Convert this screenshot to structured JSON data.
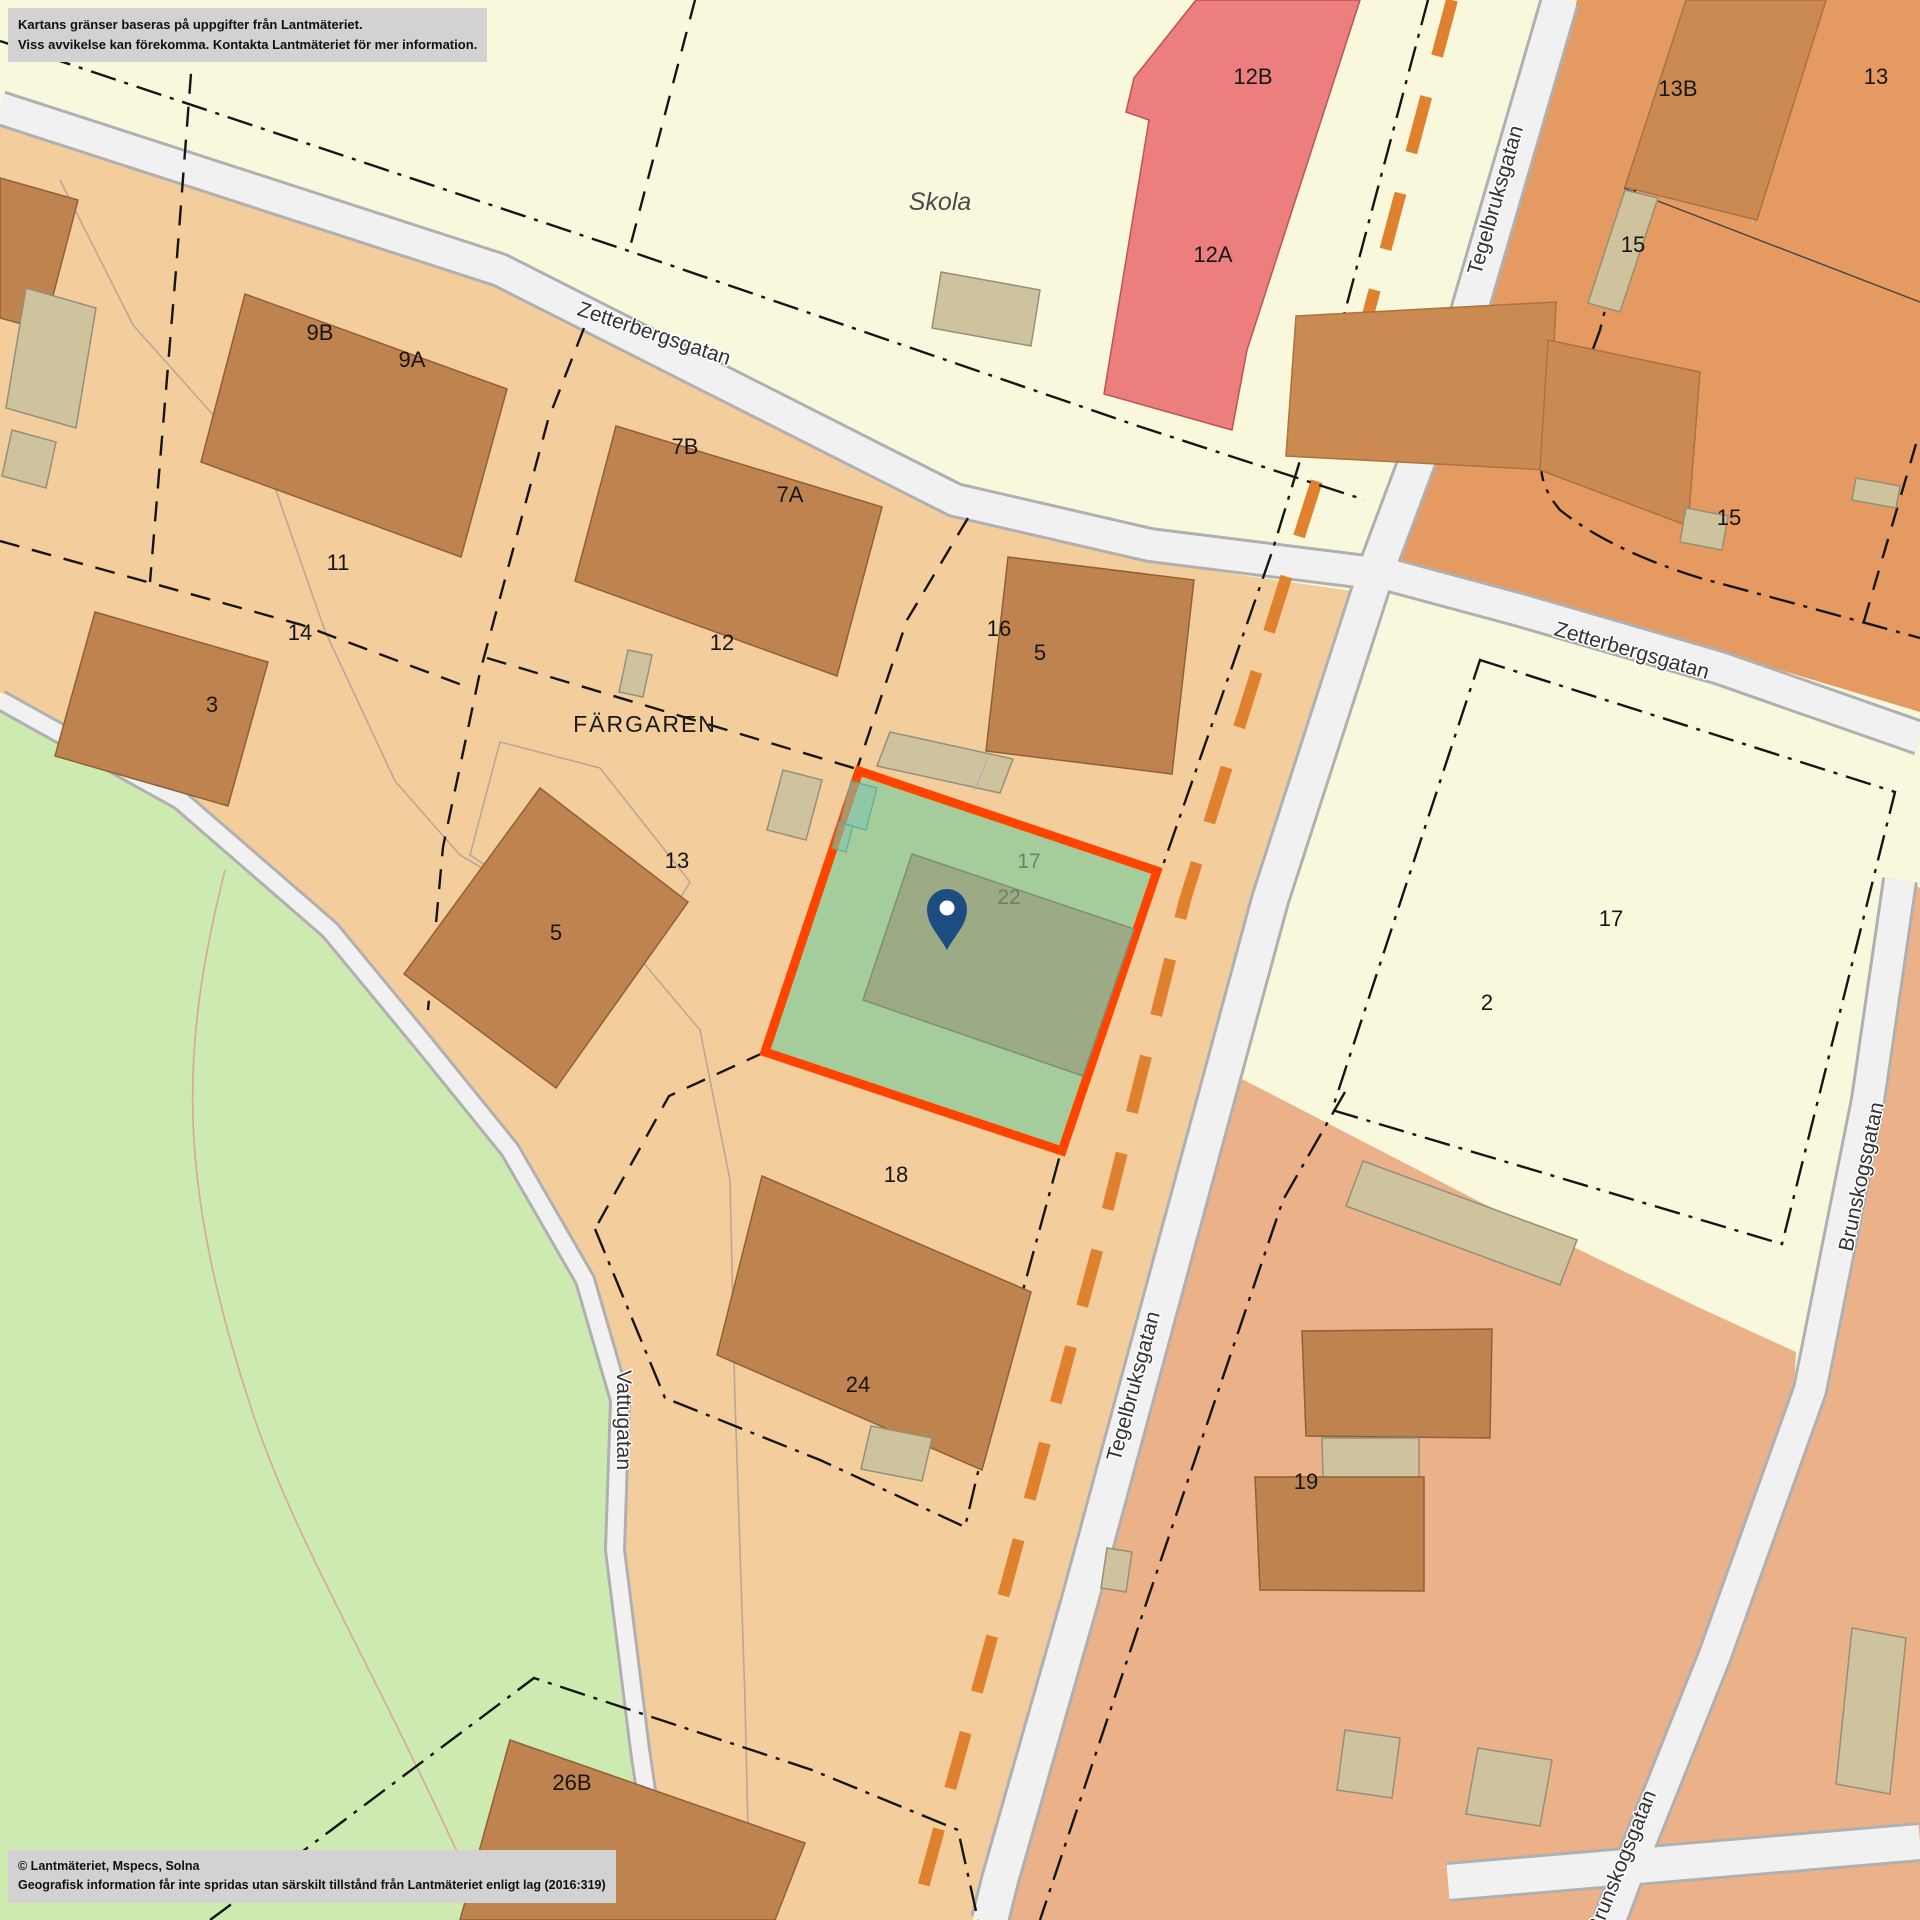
{
  "disclaimer": {
    "line1": "Kartans gränser baseras på uppgifter från Lantmäteriet.",
    "line2": "Viss avvikelse kan förekomma. Kontakta Lantmäteriet för mer information."
  },
  "attribution": {
    "line1": "© Lantmäteriet, Mspecs, Solna",
    "line2": "Geografisk information får inte spridas utan särskilt tillstånd från Lantmäteriet enligt lag (2016:319)"
  },
  "streets": {
    "zetterbergsgatan_left": "Zetterbergsgatan",
    "zetterbergsgatan_right": "Zetterbergsgatan",
    "tegelbruksgatan_top": "Tegelbruksgatan",
    "tegelbruksgatan_bottom": "Tegelbruksgatan",
    "brunskogsgatan_right": "Brunskogsgatan",
    "brunskogsgatan_bottom": "Brunskogsgatan",
    "vattugatan": "Vattugatan"
  },
  "labels": {
    "block": "FÄRGAREN",
    "school": "Skola"
  },
  "parcels": {
    "p9b": "9B",
    "p9a": "9A",
    "p7b": "7B",
    "p7a": "7A",
    "p11": "11",
    "p14": "14",
    "p12": "12",
    "p3": "3",
    "p16": "16",
    "p5_east": "5",
    "p13": "13",
    "p5_west": "5",
    "p18": "18",
    "p24": "24",
    "p26b": "26B",
    "p12b": "12B",
    "p12a": "12A",
    "p13b": "13B",
    "p13_ne": "13",
    "p15_upper": "15",
    "p15_lower": "15",
    "p17_east": "17",
    "p2": "2",
    "p19": "19"
  },
  "highlight": {
    "parcel_number": "17",
    "building_number": "22",
    "border_color": "#ff4400",
    "fill_color": "#a5cd9b",
    "building_color": "#9cab85",
    "pin_color": "#1d4c80"
  },
  "colors": {
    "boundary_dash_orange": "#e0812f",
    "road_fill": "#f1f1f1",
    "block_fill": "#f3cd9c",
    "park_fill": "#cdebb0",
    "school_fill": "#faf8dc",
    "building_fill": "#bf8350",
    "red_building_fill": "#ed7e7e",
    "salmon_fill": "#ebb189"
  }
}
